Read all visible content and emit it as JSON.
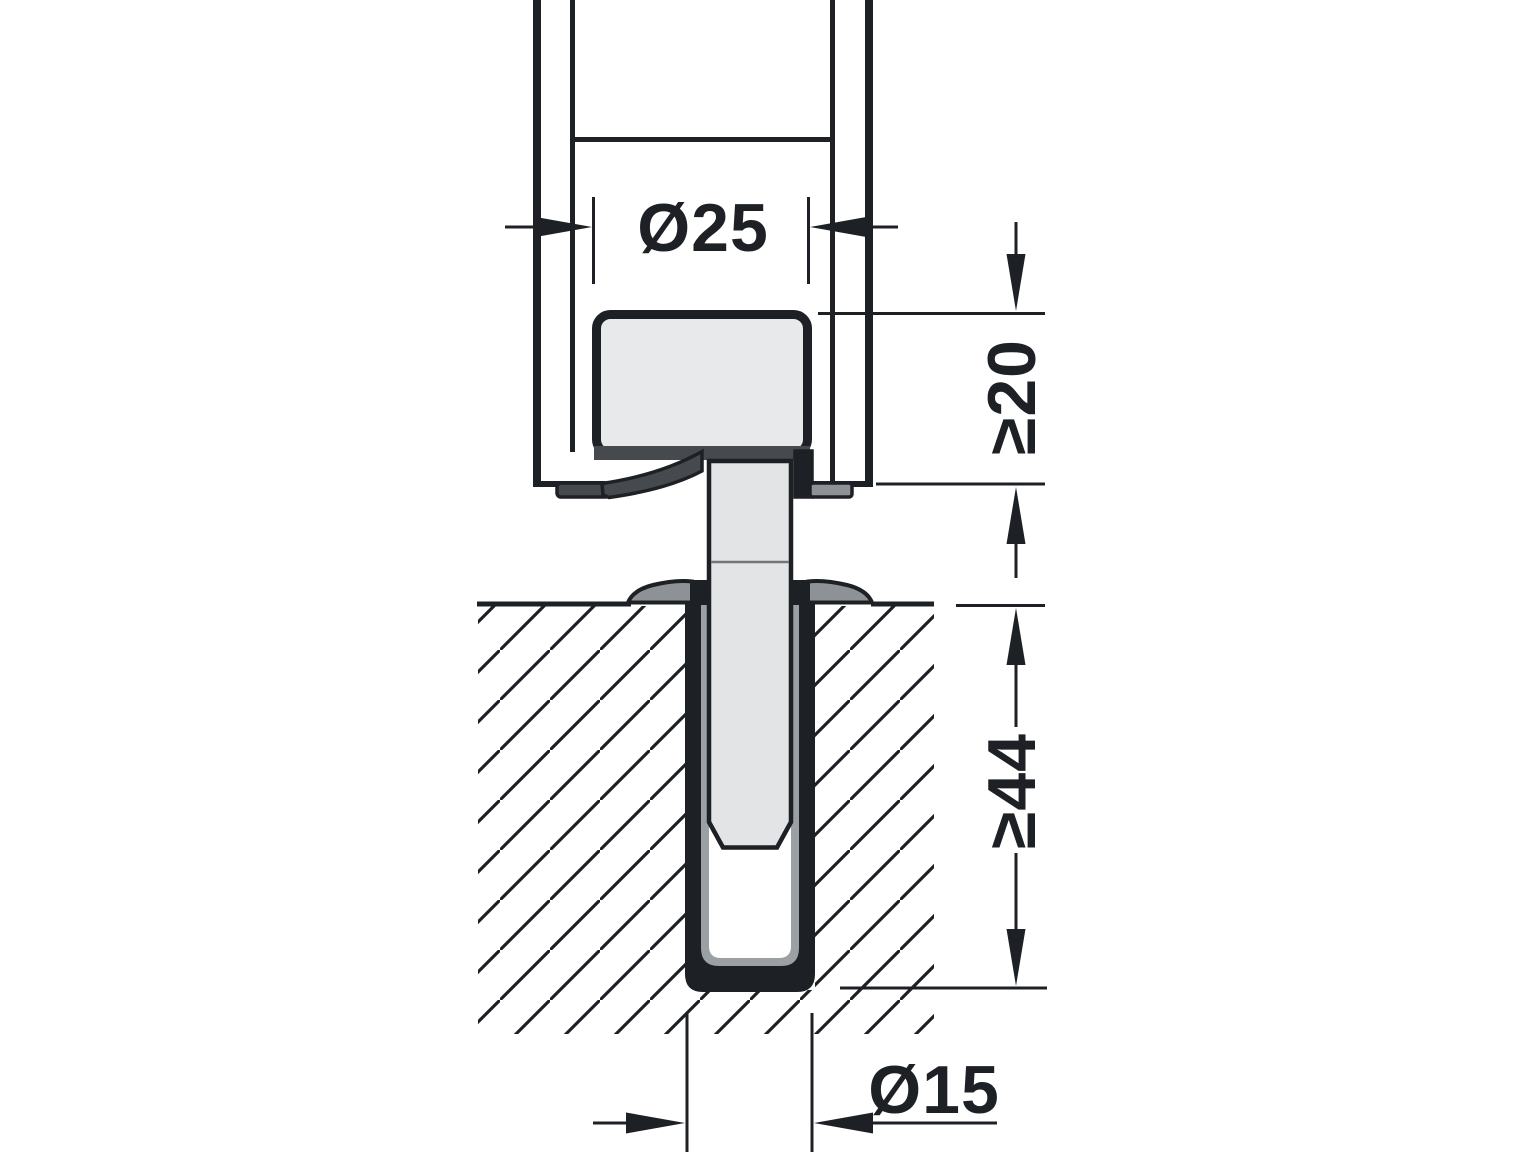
{
  "figure": {
    "type": "technical-cross-section-drawing",
    "description": "Sectional installation drawing of a door locking rod with latch housing and floor socket sleeve, with dimension annotations",
    "background": "#ffffff",
    "ink": "#1d2024",
    "fills": {
      "component_light": "#e8e9eb",
      "rod_light": "#e2e4e6",
      "metal_mid": "#8e9296",
      "plate_dark": "#46494d",
      "sleeve_lining": "#9aa0a3"
    },
    "labels": {
      "housing_diameter": "Ø25",
      "clearance_min": "≥20",
      "drill_depth_min": "≥44",
      "hole_diameter": "Ø15"
    }
  }
}
